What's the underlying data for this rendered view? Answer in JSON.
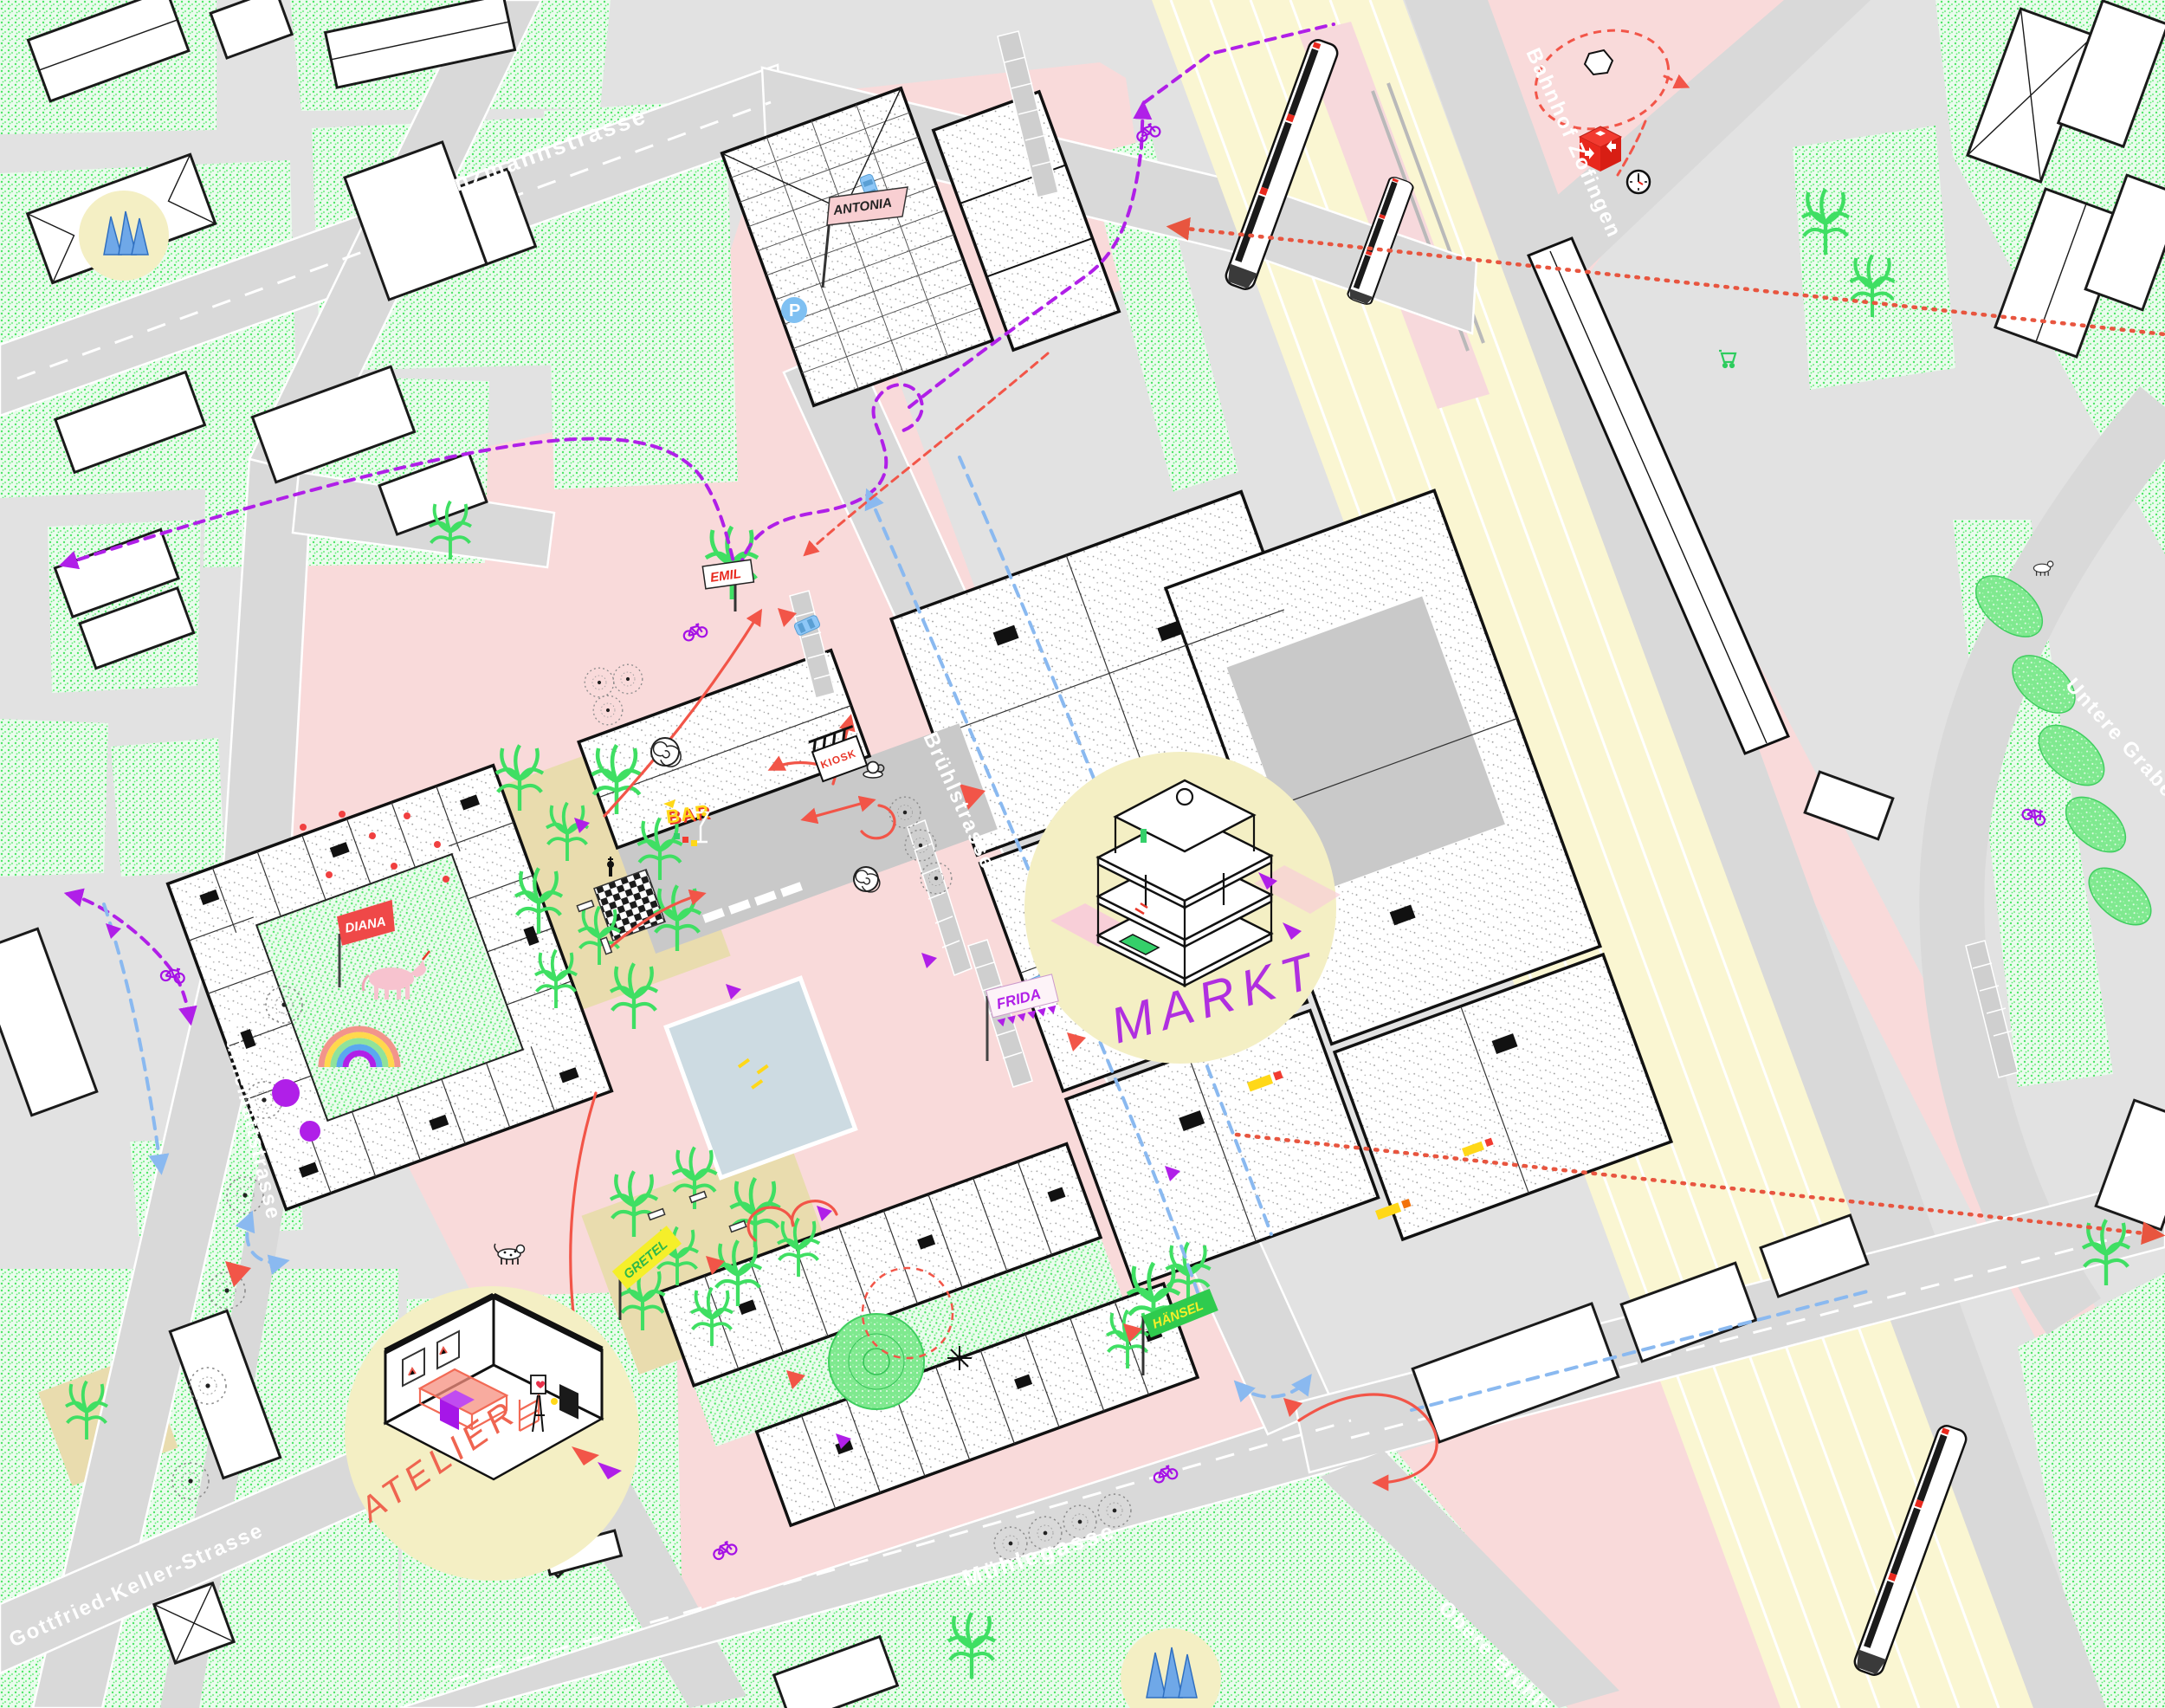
{
  "map": {
    "title_hint": "Illustrated urban site plan around the railway station",
    "streets": {
      "henzmannstrasse": "Henzmannstrasse",
      "muehlemattstrasse": "Mühlemattstrasse",
      "gottfried_keller_strasse": "Gottfried-Keller-Strasse",
      "muehlegasse": "Mühlegasse",
      "bruehlstrasse": "Brühlstrasse",
      "untere_grabenstrasse": "Untere Grabenstrasse",
      "obere_bruehlstrasse": "Obere Brühlstrasse"
    },
    "station": {
      "label": "Bahnhof Zofingen"
    },
    "vignettes": {
      "markt": "MARKT",
      "atelier": "ATELIER"
    },
    "flags": {
      "antonia": "ANTONIA",
      "emil": "EMIL",
      "diana": "DIANA",
      "gretel": "GRETEL",
      "haensel": "HÄNSEL",
      "frida": "FRIDA"
    },
    "venues": {
      "kiosk": "KIOSK",
      "bar": "BAR"
    },
    "parking": {
      "label": "P"
    },
    "icons": [
      "sbb-cube-icon",
      "station-clock-icon",
      "bicycle-icon",
      "shopping-cart-icon",
      "unicorn-icon",
      "rainbow-icon",
      "chessboard-icon",
      "martini-glass-icon",
      "coffee-cup-icon",
      "dalmatian-dog-icon",
      "white-dog-icon",
      "train-icon",
      "blue-sculpture-icon",
      "spiral-stair-icon",
      "pinwheel-icon"
    ],
    "colors": {
      "plaza_pink": "#f9dada",
      "lawn_green": "#7dea7d",
      "rail_yellow": "#faf6d2",
      "vignette_yellow": "#f4efc4",
      "road_gray": "#d9d9d9",
      "route_purple": "#b01fe8",
      "route_red": "#f25548",
      "route_blue": "#8ab9f0",
      "sbb_red": "#e8281d",
      "pool_blue": "#cddbe2",
      "grove_tan": "#e9dcae"
    }
  }
}
